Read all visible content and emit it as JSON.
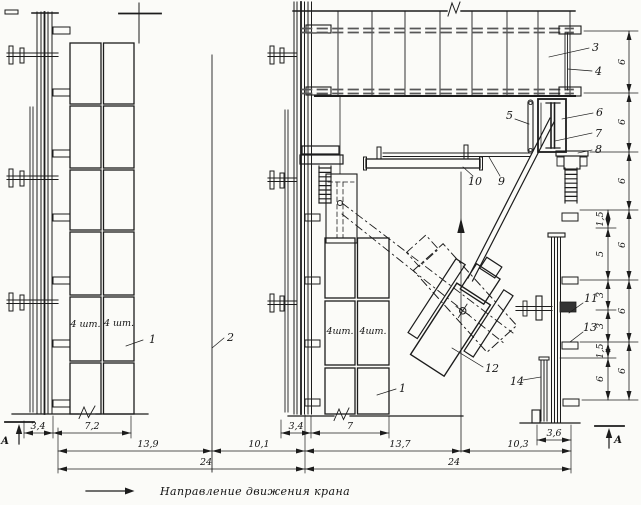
{
  "caption": {
    "text": "Направление движения крана"
  },
  "section_markers": {
    "left": "А",
    "right": "А"
  },
  "panel_labels": {
    "left_col1": "4 шт.",
    "left_col2": "4 шт.",
    "right_col1": "4шт.",
    "right_col2": "4шт."
  },
  "callouts": {
    "panels_left": "1",
    "panels_right": "1",
    "crane_axis": "2",
    "top_scaffold": "3",
    "suspension_rod": "4",
    "guide_bar": "5",
    "mounting_frame": "6",
    "frame_beam": "7",
    "support_assembly": "8",
    "rail": "9",
    "monorail_beam": "10",
    "anchor_pin": "11",
    "crane_unit": "12",
    "wall_bracket": "13",
    "column_extension": "14"
  },
  "dimensions": {
    "left_view": {
      "a": "3,4",
      "b": "7,2",
      "c": "13,9",
      "total": "24"
    },
    "middle": {
      "a": "10,1"
    },
    "right_view": {
      "a": "3,4",
      "b": "7",
      "c": "13,7",
      "d": "10,3",
      "total": "24",
      "column_width": "3,6"
    },
    "right_inner_chain": [
      "1,5",
      "5",
      "3",
      "3",
      "1,5",
      "6"
    ],
    "right_outer_chain": [
      "6",
      "6",
      "6",
      "6",
      "6",
      "6"
    ]
  }
}
